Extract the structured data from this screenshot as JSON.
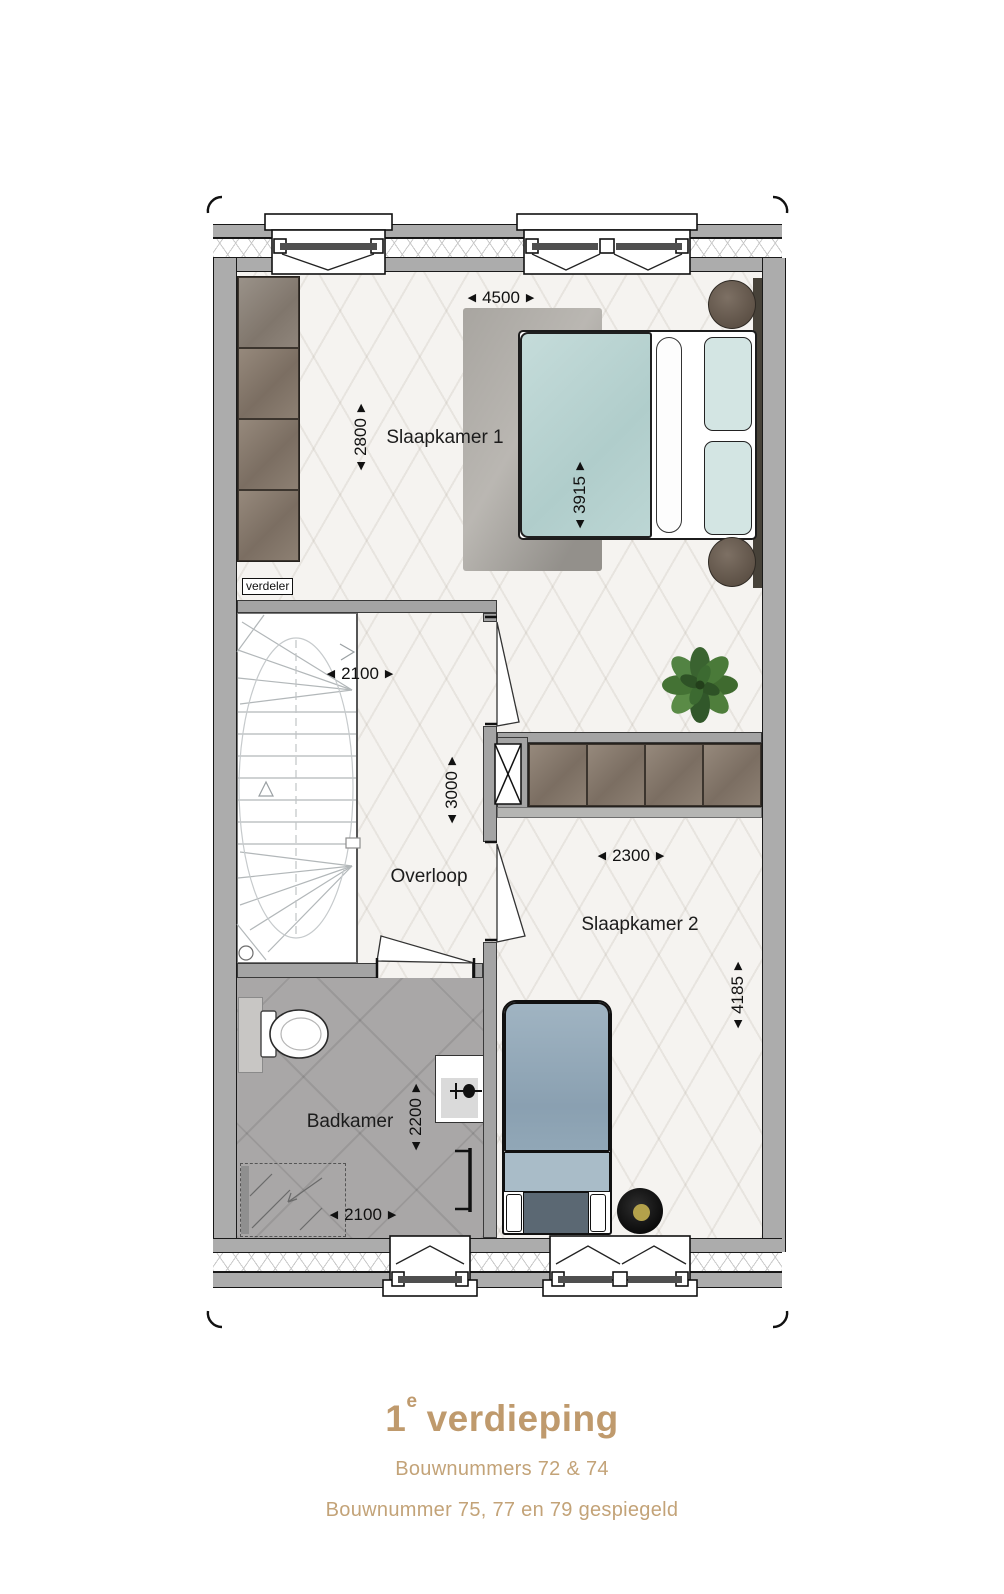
{
  "colors": {
    "accent_tan": "#bf9a6d",
    "subtitle_tan": "#c3a378",
    "wall_gray": "#acacac",
    "partition_gray": "#a4a4a4",
    "floor_light": "#f5f3f0",
    "bathroom_gray": "#a9a7a7",
    "wardrobe_brown": "#8b7d70",
    "bed1_teal": "#bad4d2",
    "bed2_blue": "#91a7b7",
    "rug_gray": "#a3a09b",
    "plant_green": "#4d7c3b",
    "pouf_gold": "#b3a14b"
  },
  "rooms": {
    "slaapkamer1": "Slaapkamer 1",
    "slaapkamer2": "Slaapkamer 2",
    "overloop": "Overloop",
    "badkamer": "Badkamer",
    "verdeler": "verdeler"
  },
  "dimensions": {
    "slaapkamer1_breedte": "4500",
    "slaapkamer1_diepte": "2800",
    "bed1_lengte": "3915",
    "trap_breedte": "2100",
    "overloop_diepte": "3000",
    "slaapkamer2_breedte": "2300",
    "slaapkamer2_diepte": "4185",
    "badkamer_diepte": "2200",
    "badkamer_breedte": "2100"
  },
  "caption": {
    "floor_number": "1",
    "floor_ordinal_suffix": "e",
    "floor_word": "verdieping",
    "subtitle_line1": "Bouwnummers 72 & 74",
    "subtitle_line2": "Bouwnummer 75, 77 en 79 gespiegeld"
  }
}
